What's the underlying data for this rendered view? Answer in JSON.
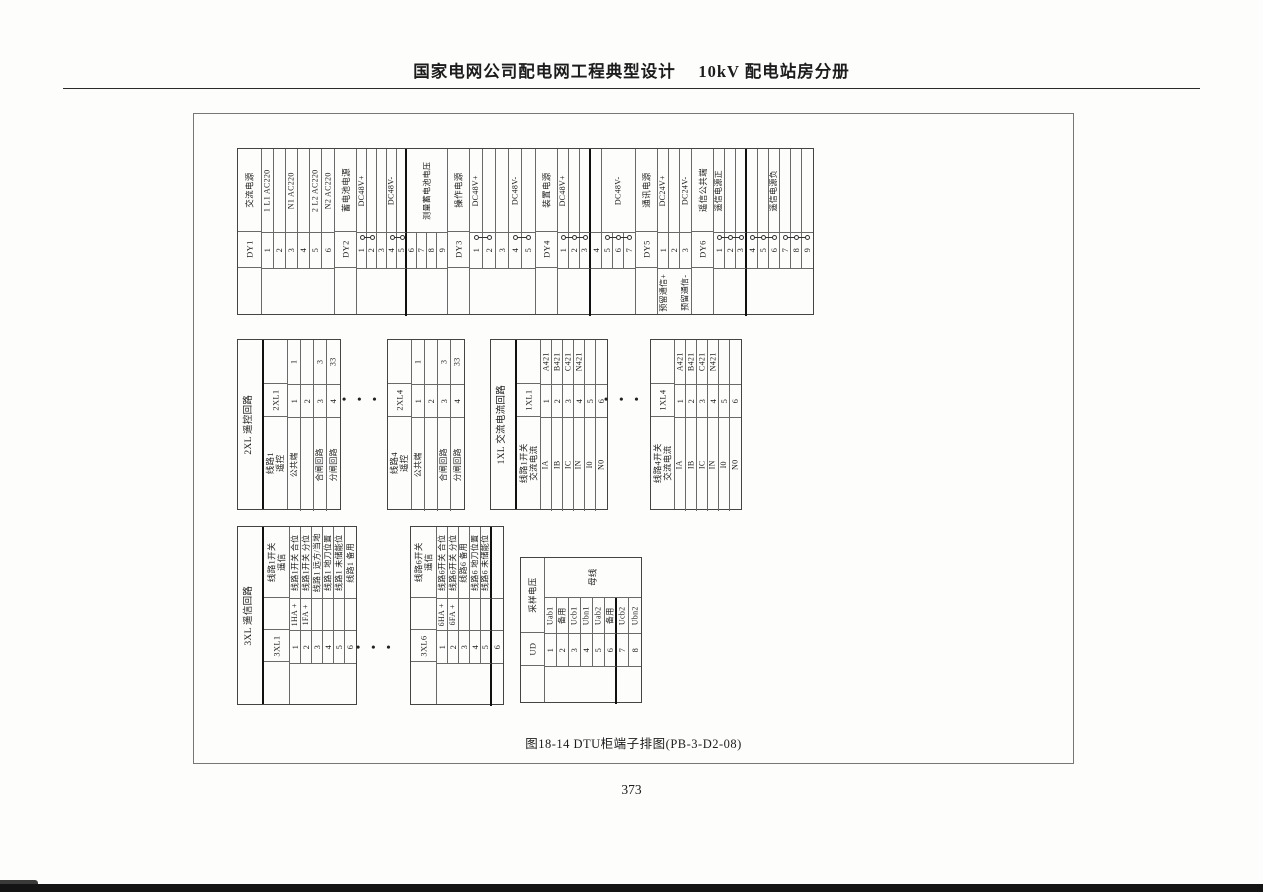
{
  "header": {
    "title": "国家电网公司配电网工程典型设计　 10kV 配电站房分册"
  },
  "figure": {
    "caption": "图18-14 DTU柜端子排图(PB-3-D2-08)",
    "page_number": "373",
    "dots_glyph": "• • •"
  },
  "colors": {
    "line": "#6a6a6a",
    "outer": "#444444",
    "thick": "#111111",
    "text": "#1c1c1c"
  },
  "dots": [
    {
      "x": 342,
      "y": 392
    },
    {
      "x": 604,
      "y": 392
    },
    {
      "x": 356,
      "y": 640
    }
  ],
  "tables": [
    {
      "name": "terminal-table-power-dy",
      "x": 237,
      "y": 148,
      "bands": [
        {
          "id": "desc",
          "h": 84
        },
        {
          "id": "num",
          "h": 36
        },
        {
          "id": "tail",
          "h": 47
        }
      ],
      "headBand": 0,
      "stripBand": 1,
      "groups": [
        {
          "strip": "DY1",
          "head": "交流电源",
          "hw": 24,
          "tw": 12,
          "terminals": [
            {
              "num": "1",
              "desc": "1 L1 AC220"
            },
            {
              "num": "2"
            },
            {
              "num": "3",
              "desc": "N1 AC220"
            },
            {
              "num": "4"
            },
            {
              "num": "5",
              "desc": "2 L2 AC220"
            },
            {
              "num": "6",
              "desc": "N2 AC220"
            }
          ]
        },
        {
          "strip": "DY2",
          "head": "蓄电池电源",
          "hw": 22,
          "tw": 10,
          "terminals": [
            {
              "num": "1",
              "desc": "DC48V+"
            },
            {
              "num": "2"
            },
            {
              "num": "3"
            },
            {
              "num": "4",
              "desc": "DC48V-"
            },
            {
              "num": "5"
            },
            {
              "num": "6",
              "desc": "测量蓄电池电压",
              "dspan": 4
            },
            {
              "num": "7"
            },
            {
              "num": "8"
            },
            {
              "num": "9"
            }
          ],
          "links": [
            [
              1,
              2
            ],
            [
              4,
              5
            ]
          ],
          "thick": [
            5
          ]
        },
        {
          "strip": "DY3",
          "head": "操作电源",
          "hw": 22,
          "tw": 13,
          "terminals": [
            {
              "num": "1",
              "desc": "DC48V+"
            },
            {
              "num": "2"
            },
            {
              "num": "3"
            },
            {
              "num": "4",
              "desc": "DC48V-"
            },
            {
              "num": "5"
            }
          ],
          "links": [
            [
              1,
              2
            ],
            [
              4,
              5
            ]
          ]
        },
        {
          "strip": "DY4",
          "head": "装置电源",
          "hw": 22,
          "tw": 11,
          "terminals": [
            {
              "num": "1",
              "desc": "DC48V+"
            },
            {
              "num": "2"
            },
            {
              "num": "3"
            },
            {
              "num": "4"
            },
            {
              "num": "5",
              "desc": "DC48V-",
              "dspan": 3
            },
            {
              "num": "6"
            },
            {
              "num": "7"
            }
          ],
          "links": [
            [
              1,
              2,
              3
            ],
            [
              5,
              6,
              7
            ]
          ],
          "thick": [
            3
          ]
        },
        {
          "strip": "DY5",
          "head": "通讯电源",
          "hw": 22,
          "tw": 11,
          "terminals": [
            {
              "num": "1",
              "desc": "DC24V+",
              "tail": "预留通信+"
            },
            {
              "num": "2"
            },
            {
              "num": "3",
              "desc": "DC24V-",
              "tail": "预留通信-"
            }
          ]
        },
        {
          "strip": "DY6",
          "head": "遥信公共端",
          "hw": 22,
          "tw": 11,
          "terminals": [
            {
              "num": "1",
              "desc": "遥信电源正"
            },
            {
              "num": "2"
            },
            {
              "num": "3"
            },
            {
              "num": "4"
            },
            {
              "num": "5"
            },
            {
              "num": "6",
              "desc": "遥信电源负"
            },
            {
              "num": "7"
            },
            {
              "num": "8"
            },
            {
              "num": "9"
            }
          ],
          "links": [
            [
              1,
              2,
              3
            ],
            [
              4,
              5,
              6
            ],
            [
              7,
              8,
              9
            ]
          ],
          "thick": [
            3
          ]
        }
      ]
    },
    {
      "name": "terminal-table-2xl1",
      "x": 237,
      "y": 339,
      "title": "2XL 遥控回路",
      "titleW": 26,
      "bands": [
        {
          "id": "wire",
          "h": 45
        },
        {
          "id": "num",
          "h": 33
        },
        {
          "id": "desc",
          "h": 93
        }
      ],
      "headBand": 2,
      "stripBand": 1,
      "groups": [
        {
          "strip": "2XL1",
          "head": "线路1\n遥控",
          "hw": 24,
          "tw": 13,
          "terminals": [
            {
              "num": "1",
              "wire": "1",
              "desc": "公共端"
            },
            {
              "num": "2"
            },
            {
              "num": "3",
              "wire": "3",
              "desc": "合闸回路"
            },
            {
              "num": "4",
              "wire": "33",
              "desc": "分闸回路"
            }
          ]
        }
      ]
    },
    {
      "name": "terminal-table-2xl4",
      "x": 387,
      "y": 339,
      "bands": [
        {
          "id": "wire",
          "h": 45
        },
        {
          "id": "num",
          "h": 33
        },
        {
          "id": "desc",
          "h": 93
        }
      ],
      "headBand": 2,
      "stripBand": 1,
      "groups": [
        {
          "strip": "2XL4",
          "head": "线路4\n遥控",
          "hw": 24,
          "tw": 13,
          "terminals": [
            {
              "num": "1",
              "wire": "1",
              "desc": "公共端"
            },
            {
              "num": "2"
            },
            {
              "num": "3",
              "wire": "3",
              "desc": "合闸回路"
            },
            {
              "num": "4",
              "wire": "33",
              "desc": "分闸回路"
            }
          ]
        }
      ]
    },
    {
      "name": "terminal-table-1xl1",
      "x": 490,
      "y": 339,
      "title": "1XL 交流电流回路",
      "titleW": 26,
      "bands": [
        {
          "id": "wire",
          "h": 45
        },
        {
          "id": "num",
          "h": 33
        },
        {
          "id": "desc",
          "h": 93
        }
      ],
      "headBand": 2,
      "stripBand": 1,
      "groups": [
        {
          "strip": "1XL1",
          "head": "线路1开关\n交流电流",
          "hw": 24,
          "tw": 11,
          "terminals": [
            {
              "num": "1",
              "wire": "A421",
              "desc": "IA"
            },
            {
              "num": "2",
              "wire": "B421",
              "desc": "IB"
            },
            {
              "num": "3",
              "wire": "C421",
              "desc": "IC"
            },
            {
              "num": "4",
              "wire": "N421",
              "desc": "IN"
            },
            {
              "num": "5",
              "desc": "I0"
            },
            {
              "num": "6",
              "desc": "N0"
            }
          ]
        }
      ]
    },
    {
      "name": "terminal-table-1xl4",
      "x": 650,
      "y": 339,
      "bands": [
        {
          "id": "wire",
          "h": 45
        },
        {
          "id": "num",
          "h": 33
        },
        {
          "id": "desc",
          "h": 93
        }
      ],
      "headBand": 2,
      "stripBand": 1,
      "groups": [
        {
          "strip": "1XL4",
          "head": "线路4开关\n交流电流",
          "hw": 24,
          "tw": 11,
          "terminals": [
            {
              "num": "1",
              "wire": "A421",
              "desc": "IA"
            },
            {
              "num": "2",
              "wire": "B421",
              "desc": "IB"
            },
            {
              "num": "3",
              "wire": "C421",
              "desc": "IC"
            },
            {
              "num": "4",
              "wire": "N421",
              "desc": "IN"
            },
            {
              "num": "5",
              "desc": "I0"
            },
            {
              "num": "6",
              "desc": "N0"
            }
          ]
        }
      ]
    },
    {
      "name": "terminal-table-3xl1",
      "x": 237,
      "y": 526,
      "title": "3XL 遥信回路",
      "titleW": 26,
      "bands": [
        {
          "id": "desc",
          "h": 72
        },
        {
          "id": "wire",
          "h": 32
        },
        {
          "id": "num",
          "h": 33
        },
        {
          "id": "tail",
          "h": 42
        }
      ],
      "headBand": 0,
      "stripBand": 2,
      "groups": [
        {
          "strip": "3XL1",
          "head": "线路1开关\n遥信",
          "hw": 26,
          "tw": 11,
          "terminals": [
            {
              "num": "1",
              "desc": "线路1开关 合位",
              "wire": "1HA +"
            },
            {
              "num": "2",
              "desc": "线路1开关 分位",
              "wire": "1FA +"
            },
            {
              "num": "3",
              "desc": "线路1 远方/当地"
            },
            {
              "num": "4",
              "desc": "线路1 地刀位置"
            },
            {
              "num": "5",
              "desc": "线路1 未储能位"
            },
            {
              "num": "6",
              "desc": "线路1 备用"
            }
          ]
        }
      ]
    },
    {
      "name": "terminal-table-3xl6",
      "x": 410,
      "y": 526,
      "bands": [
        {
          "id": "desc",
          "h": 72
        },
        {
          "id": "wire",
          "h": 32
        },
        {
          "id": "num",
          "h": 33
        },
        {
          "id": "tail",
          "h": 42
        }
      ],
      "headBand": 0,
      "stripBand": 2,
      "groups": [
        {
          "strip": "3XL6",
          "head": "线路6开关\n遥信",
          "hw": 26,
          "tw": 11,
          "terminals": [
            {
              "num": "1",
              "desc": "线路6开关 合位",
              "wire": "6HA +"
            },
            {
              "num": "2",
              "desc": "线路6开关 分位",
              "wire": "6FA +"
            },
            {
              "num": "3",
              "desc": "线路6 备用"
            },
            {
              "num": "4",
              "desc": "线路6 地刀位置"
            },
            {
              "num": "5",
              "desc": "线路6 未储能位"
            },
            {
              "num": "6"
            }
          ],
          "thick": [
            5
          ]
        }
      ]
    },
    {
      "name": "terminal-table-ud",
      "x": 520,
      "y": 557,
      "sub": "母线",
      "bands": [
        {
          "id": "sub",
          "h": 40
        },
        {
          "id": "desc",
          "h": 36
        },
        {
          "id": "num",
          "h": 33
        },
        {
          "id": "tail",
          "h": 37
        }
      ],
      "headBand": 0,
      "headSpan": 2,
      "stripBand": 2,
      "groups": [
        {
          "strip": "UD",
          "head": "采样电压",
          "hw": 24,
          "tw": 12,
          "terminals": [
            {
              "num": "1",
              "desc": "Uab1"
            },
            {
              "num": "2",
              "desc": "备用"
            },
            {
              "num": "3",
              "desc": "Ucb1"
            },
            {
              "num": "4",
              "desc": "Ubn1"
            },
            {
              "num": "5",
              "desc": "Uab2"
            },
            {
              "num": "6",
              "desc": "备用"
            },
            {
              "num": "7",
              "desc": "Ucb2"
            },
            {
              "num": "8",
              "desc": "Ubn2"
            }
          ],
          "thick": [
            6
          ]
        }
      ]
    }
  ]
}
